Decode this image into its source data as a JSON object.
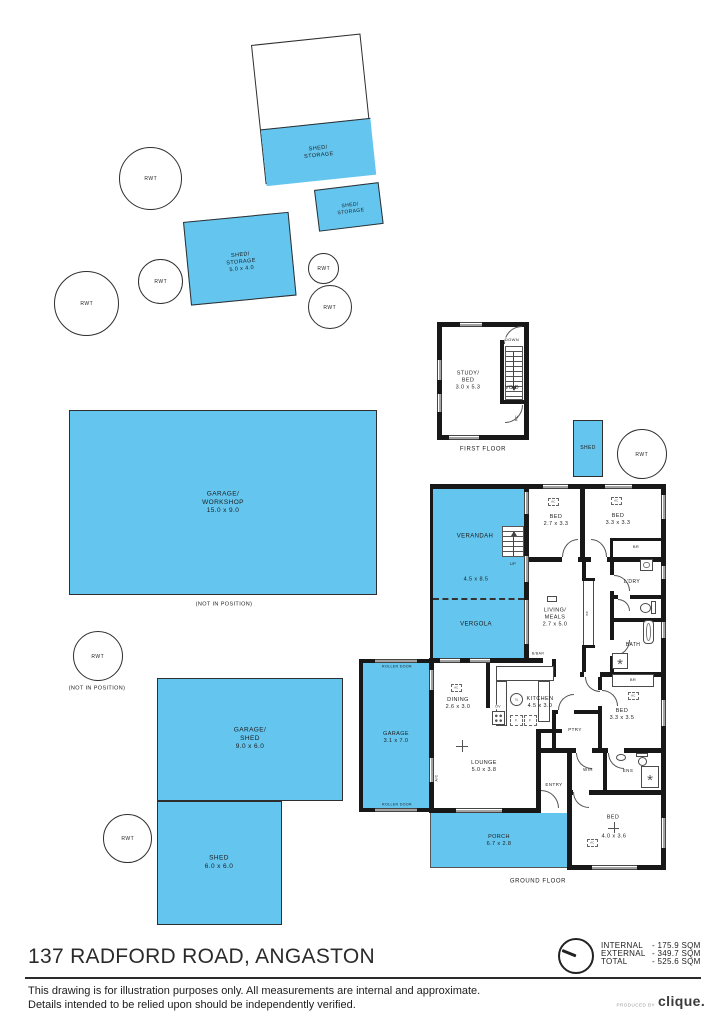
{
  "colors": {
    "plan_blue": "#64c5ee",
    "wall": "#181818"
  },
  "labels": {
    "rwt": "RWT",
    "shed_storage": "SHED/\nSTORAGE",
    "shed_storage_5040": "SHED/\nSTORAGE\n5.0 x 4.0",
    "garage_workshop": "GARAGE/\nWORKSHOP\n15.0 x 9.0",
    "not_in_position": "(NOT IN POSITION)",
    "garage_shed": "GARAGE/\nSHED\n9.0 x 6.0",
    "shed_6x6": "SHED\n6.0 x 6.0",
    "shed_small": "SHED",
    "first_floor": "FIRST FLOOR",
    "ground_floor": "GROUND FLOOR",
    "study_bed": "STUDY/\nBED\n3.0 x 5.3",
    "void": "VOID",
    "down": "DOWN",
    "up": "UP",
    "rc": "RC",
    "verandah": "VERANDAH",
    "verandah_dim": "4.5 x 8.5",
    "vergola": "VERGOLA",
    "bed_2733": "BED\n2.7 x 3.3",
    "bed_3333": "BED\n3.3 x 3.3",
    "br": "BR",
    "ldry": "L'DRY",
    "bath": "BATH",
    "living_meals": "LIVING/\nMEALS\n2.7 x 5.0",
    "bc": "BC",
    "bbar": "B/BAR",
    "dining": "DINING\n2.6 x 3.0",
    "kitchen": "KITCHEN\n4.5 x 3.0",
    "sl": "SL",
    "ov": "OV",
    "f": "F",
    "ptry": "PTRY",
    "bed_3335": "BED\n3.3 x 3.5",
    "lounge": "LOUNGE\n5.0 x 3.8",
    "wir": "WIR",
    "ens": "ENS",
    "entry": "ENTRY",
    "bed4": "BED",
    "bed4_dim": "4.0 x 3.6",
    "garage": "GARAGE\n3.1 x 7.0",
    "roller_door": "ROLLER DOOR",
    "ac_wall": "A/C",
    "ac_unit": "AC",
    "porch": "PORCH\n6.7 x 2.8",
    "shower_glyph": "*"
  },
  "areas": {
    "internal_label": "INTERNAL",
    "internal_value": "-  175.9 SQM",
    "external_label": "EXTERNAL",
    "external_value": "-  349.7 SQM",
    "total_label": "TOTAL",
    "total_value": "-  525.6 SQM"
  },
  "footer": {
    "title": "137 RADFORD ROAD, ANGASTON",
    "disclaimer1": "This drawing is for illustration purposes only. All measurements are internal and approximate.",
    "disclaimer2": "Details intended to be relied upon should be independently verified.",
    "produced_by": "PRODUCED BY",
    "brand": "clique."
  }
}
